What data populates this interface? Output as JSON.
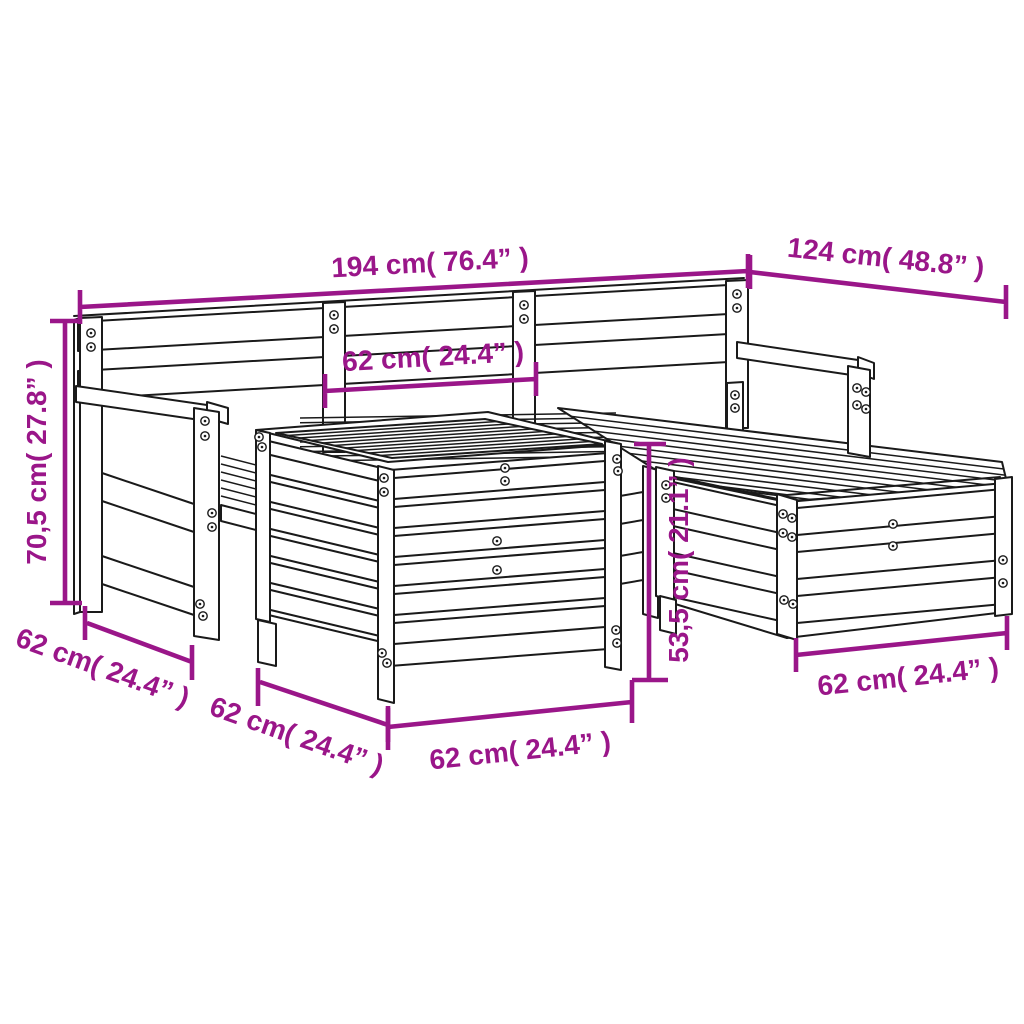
{
  "colors": {
    "dimension": "#9A1689",
    "line_art": "#1a1a1a",
    "background": "#ffffff"
  },
  "annotations": [
    {
      "id": "overall-width",
      "label": "194 cm( 76.4” )"
    },
    {
      "id": "overall-depth",
      "label": "124 cm( 48.8” )"
    },
    {
      "id": "backrest-section-width",
      "label": "62 cm( 24.4” )"
    },
    {
      "id": "overall-height",
      "label": "70,5 cm( 27.8” )"
    },
    {
      "id": "armchair-seat-depth",
      "label": "62 cm( 24.4” )"
    },
    {
      "id": "table-side-depth",
      "label": "62 cm( 24.4” )"
    },
    {
      "id": "table-front-width",
      "label": "62 cm( 24.4” )"
    },
    {
      "id": "seat-height",
      "label": "53,5 cm( 21.1” )"
    },
    {
      "id": "footstool-width",
      "label": "62 cm( 24.4” )"
    }
  ]
}
